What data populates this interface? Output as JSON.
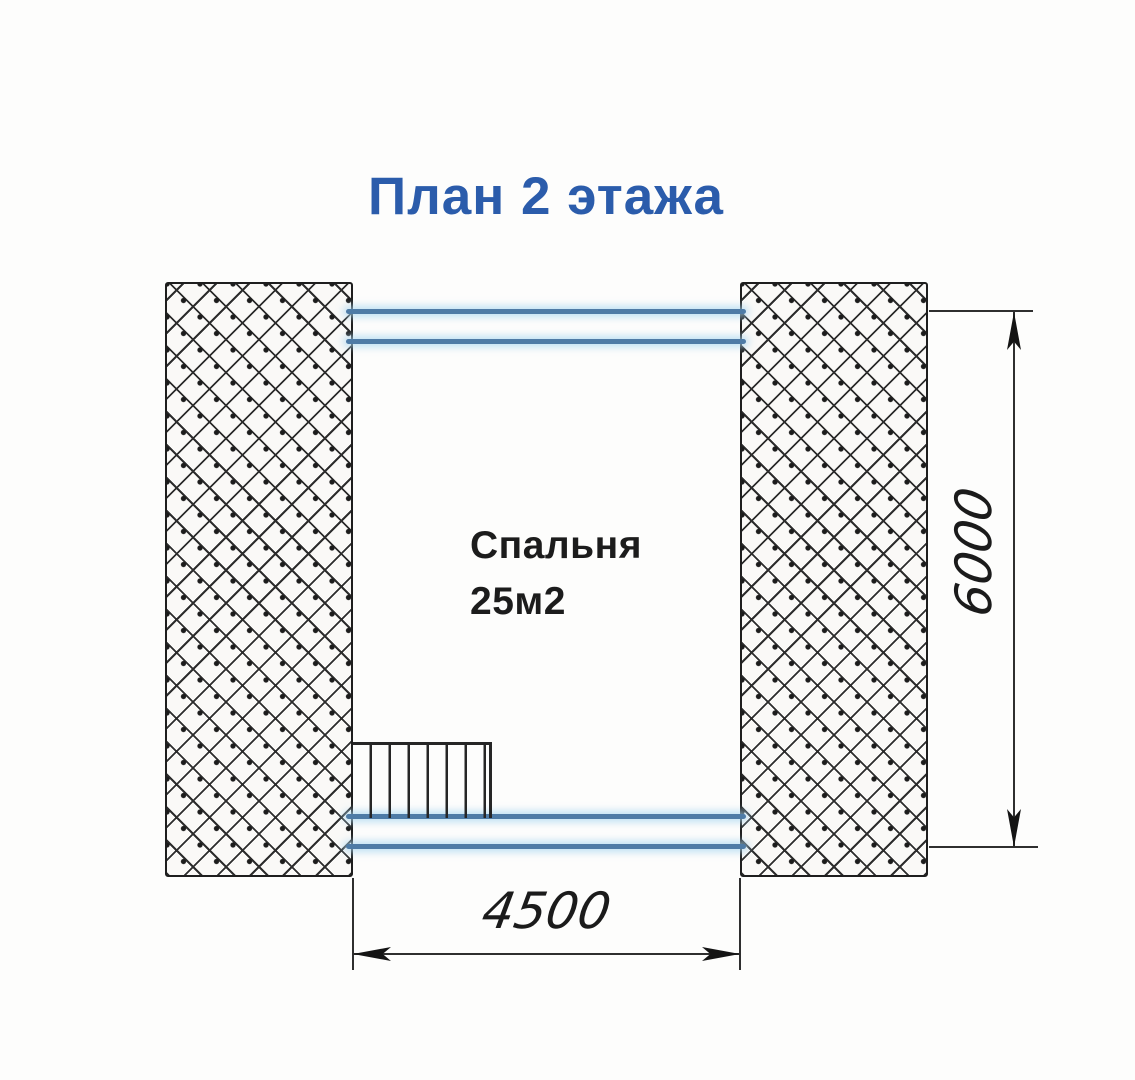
{
  "title": {
    "text": "План 2 этажа"
  },
  "room": {
    "name": "Спальня",
    "area": "25м2"
  },
  "dimensions": {
    "width_label": "4500",
    "height_label": "6000"
  },
  "colors": {
    "title_blue": "#2b5cab",
    "wall_line_blue": "#4e7ba6",
    "drawing_line": "#2a2a2a"
  }
}
